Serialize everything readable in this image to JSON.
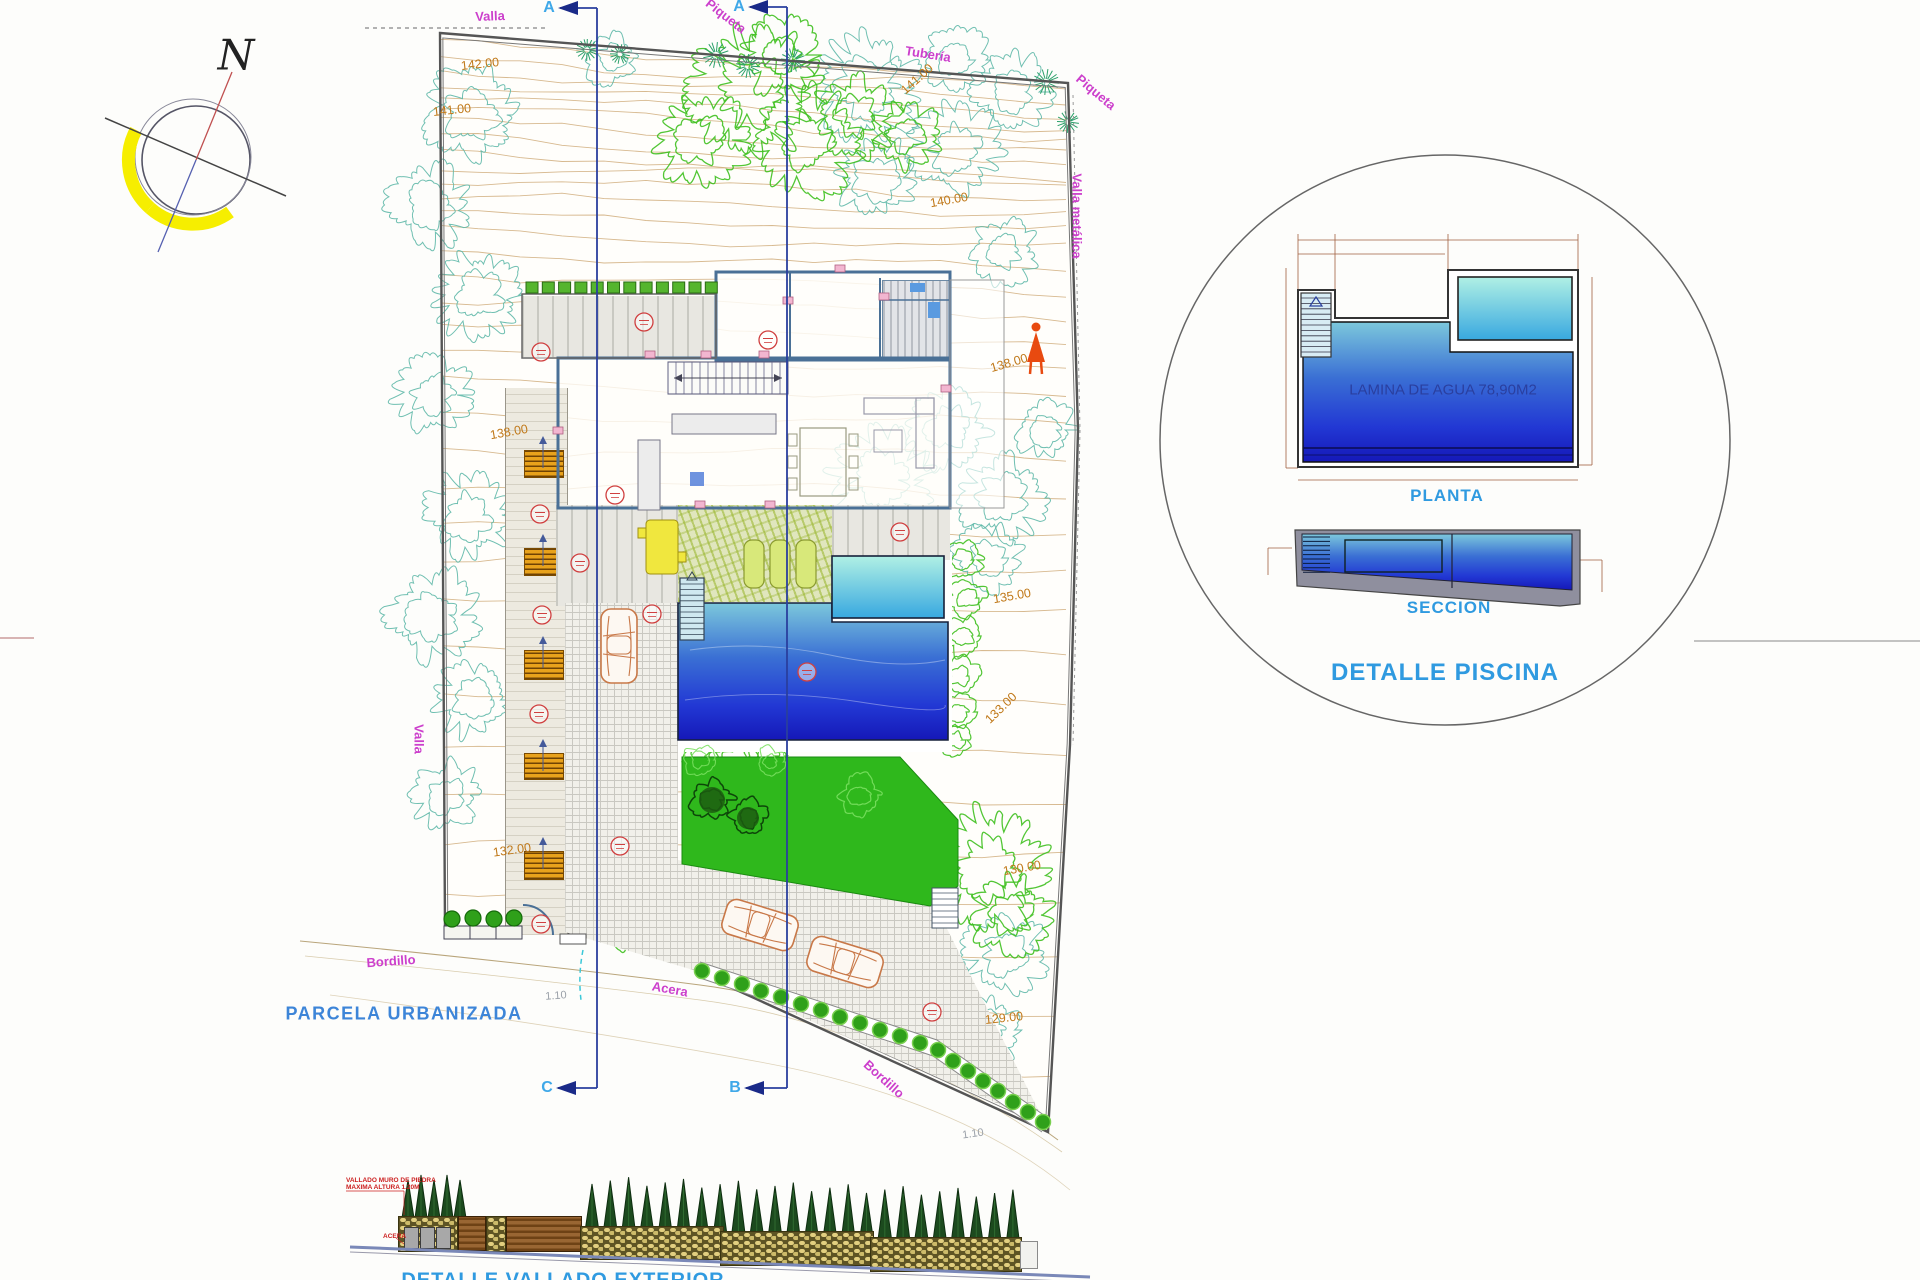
{
  "compass": {
    "north_label": "N"
  },
  "site_plan": {
    "area_label": "PARCELA URBANIZADA",
    "boundary_labels": [
      "Valla",
      "Piqueta",
      "Tubería",
      "Piqueta",
      "Valla metálica",
      "Valla",
      "Bordillo",
      "Acera",
      "Bordillo"
    ],
    "contour_labels": [
      "142.00",
      "141.00",
      "141.00",
      "140.00",
      "138.00",
      "138.00",
      "135.00",
      "133.00",
      "132.00",
      "130.00",
      "129.00"
    ],
    "dimension_labels": [
      "1.10",
      "1.10"
    ],
    "section_markers": [
      "A",
      "A",
      "C",
      "B"
    ]
  },
  "pool_detail": {
    "title": "DETALLE PISCINA",
    "plan_caption": "PLANTA",
    "section_caption": "SECCION",
    "water_label": "LAMINA DE AGUA 78,90M2"
  },
  "fence_detail": {
    "title": "DETALLE VALLADO EXTERIOR",
    "note_line1": "VALLADO MURO DE PIEDRA",
    "note_line2": "MAXIMA ALTURA 1.20M",
    "sidewalk_label": "ACERA"
  },
  "colors": {
    "label_magenta": "#cc3fcc",
    "label_orange": "#c07818",
    "label_blue": "#2f9ae0",
    "water_deep": "#1518b8",
    "water_light": "#5bb8d8",
    "spa_light": "#b0f0e4",
    "lawn_green": "#2fb81c"
  }
}
